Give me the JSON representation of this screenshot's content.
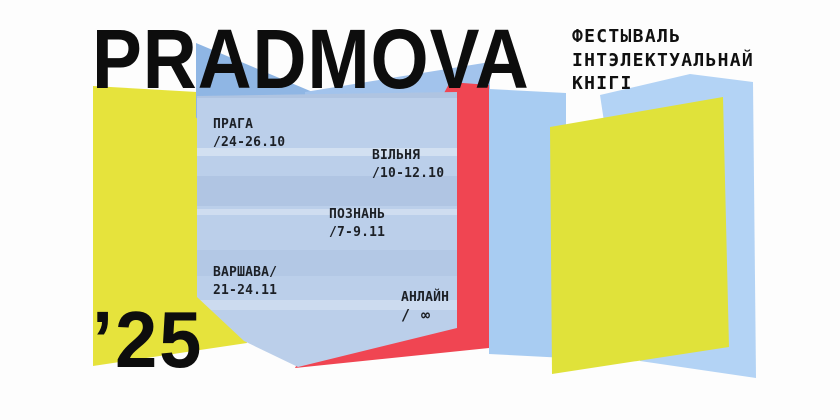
{
  "title": "PRADMOVA",
  "year": "’25",
  "subtitle": {
    "line1": "ФЕСТЫВАЛЬ",
    "line2": "ІНТЭЛЕКТУАЛЬНАЙ",
    "line3": "КНІГІ"
  },
  "events": [
    {
      "city": "ПРАГА",
      "date": "/24-26.10"
    },
    {
      "city": "ВІЛЬНЯ",
      "date": "/10-12.10"
    },
    {
      "city": "ПОЗНАНЬ",
      "date": "/7-9.11"
    },
    {
      "city": "ВАРШАВА/",
      "date": "21-24.11"
    },
    {
      "city": "АНЛАЙН",
      "date": "/ ∞"
    }
  ],
  "colors": {
    "background": "#fdfdfd",
    "text": "#0d0d0d",
    "left_yellow": "#e6e33c",
    "right_yellow": "#e0e23a",
    "front_page_blue": "#bbcfea",
    "back_peak_blue": "#8fb6e4",
    "band_blue": "#a2c3ec",
    "panel_blue": "#a8ccf2",
    "right_blue": "#b3d3f5",
    "red": "#f04552"
  }
}
